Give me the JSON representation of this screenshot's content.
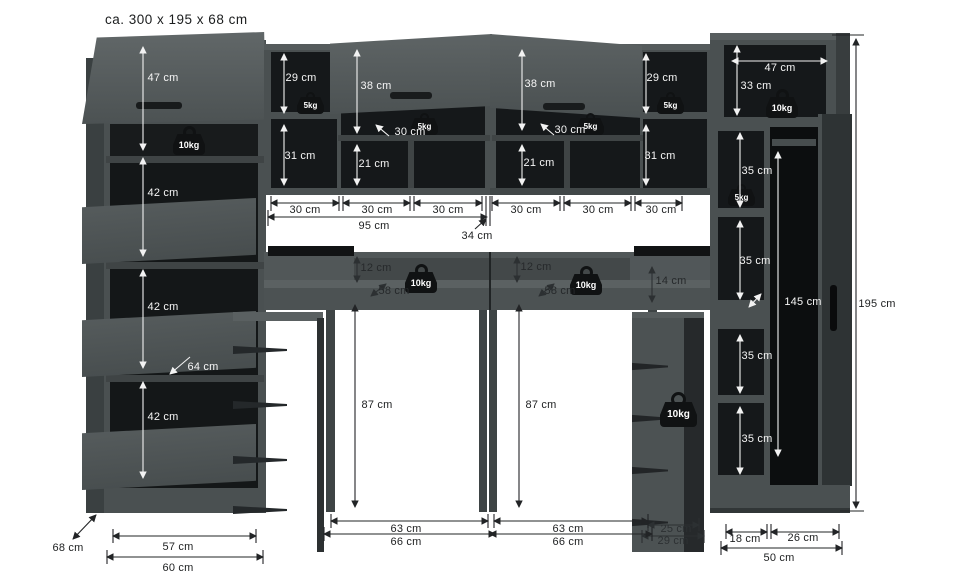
{
  "title": "ca. 300 x 195 x 68 cm",
  "weight_badges": {
    "five": "5kg",
    "ten": "10kg"
  },
  "colors": {
    "panel": "#4a5051",
    "interior": "#15181a",
    "dim_on_dark": "#f2f2f2",
    "dim_on_light": "#222426"
  },
  "dims": {
    "left_flap": "47 cm",
    "left_sec1": "42 cm",
    "left_sec2": "42 cm",
    "left_sec3": "42 cm",
    "left_diag": "64 cm",
    "ul_top_cell": "29 cm",
    "ul_bot_cell": "31 cm",
    "ul_door": "38 cm",
    "ul_shelf_diag": "30 cm",
    "ul_small": "21 cm",
    "ur_door": "38 cm",
    "ur_shelf_diag": "30 cm",
    "ur_top_cell": "29 cm",
    "ur_bot_cell": "31 cm",
    "ur_small": "21 cm",
    "rowl1": "30 cm",
    "rowl2": "30 cm",
    "rowl3": "30 cm",
    "rowl_total": "95 cm",
    "center_gap": "34 cm",
    "rowr1": "30 cm",
    "rowr2": "30 cm",
    "rowr3": "30 cm",
    "rw_width": "47 cm",
    "rw_top": "33 cm",
    "rw_c1": "35 cm",
    "rw_c2": "35 cm",
    "rw_c3": "35 cm",
    "rw_c4": "35 cm",
    "rw_hang": "145 cm",
    "height_total": "195 cm",
    "ledge_l": "12 cm",
    "desk_diag_l": "58 cm",
    "ledge_r": "12 cm",
    "desk_diag_r": "58 cm",
    "box_r": "14 cm",
    "clear_l": "87 cm",
    "clear_r": "87 cm",
    "open_l_in": "63 cm",
    "open_l_out": "66 cm",
    "open_r_in": "63 cm",
    "open_r_out": "66 cm",
    "cab_l_in": "57 cm",
    "cab_l_out": "60 cm",
    "depth": "68 cm",
    "ped_in": "25 cm",
    "ped_out": "29 cm",
    "rw_shelf_w": "18 cm",
    "rw_hang_w": "26 cm",
    "rw_w_total": "50 cm"
  }
}
